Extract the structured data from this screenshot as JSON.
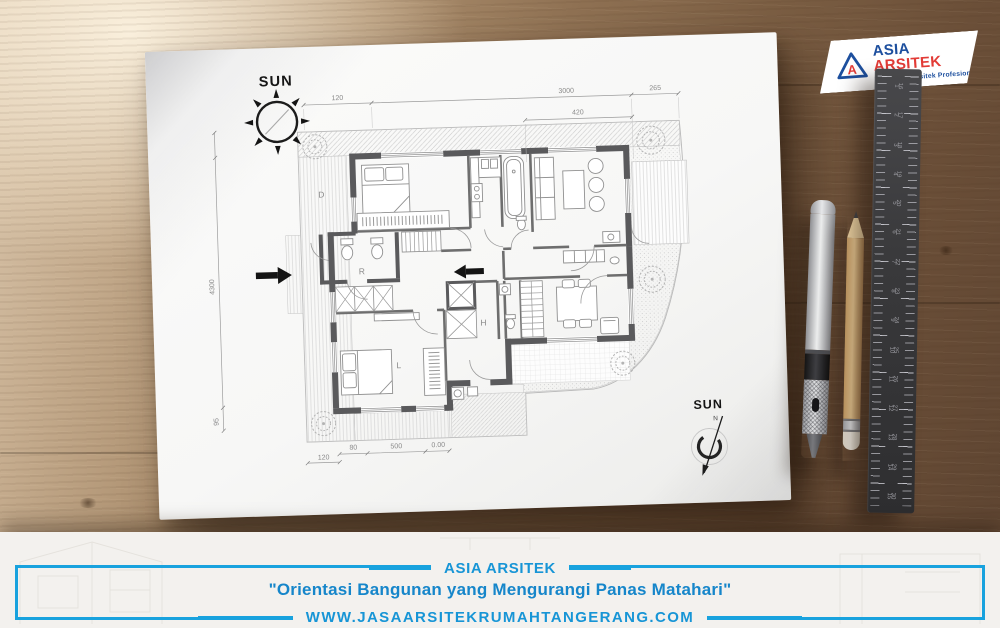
{
  "logo": {
    "letter": "A",
    "brand_primary": "ASIA",
    "brand_secondary": "ARSITEK",
    "tagline": "Konsultan Arsitek Profesional"
  },
  "plan": {
    "sun_top_label": "SUN",
    "compass_label": "SUN",
    "compass_north": "N",
    "room_labels": {
      "d": "D",
      "r": "R",
      "l": "L",
      "h": "H"
    },
    "dims": {
      "top_left": "120",
      "top_main": "3000",
      "top_right": "265",
      "top_sub": "420",
      "left_main": "4300",
      "left_sub": "95",
      "bottom_left": "120",
      "bottom_a": "80",
      "bottom_b": "500",
      "bottom_c": "0.00"
    }
  },
  "desk": {
    "ruler": {
      "left_numbers": [
        "1",
        "2",
        "3",
        "4",
        "5",
        "6",
        "7",
        "8",
        "9",
        "10",
        "11",
        "12",
        "13",
        "14",
        "15"
      ],
      "right_numbers": [
        "16",
        "17",
        "18",
        "19",
        "20",
        "21",
        "22",
        "23",
        "24",
        "25",
        "26",
        "27",
        "28",
        "29",
        "30"
      ]
    }
  },
  "banner": {
    "brand": "ASIA ARSITEK",
    "headline": "\"Orientasi Bangunan yang Mengurangi Panas Matahari\"",
    "url": "WWW.JASAARSITEKRUMAHTANGERANG.COM"
  },
  "colors": {
    "accent_blue": "#18a2de",
    "logo_blue": "#1d4f9e",
    "logo_red": "#e23b36"
  }
}
